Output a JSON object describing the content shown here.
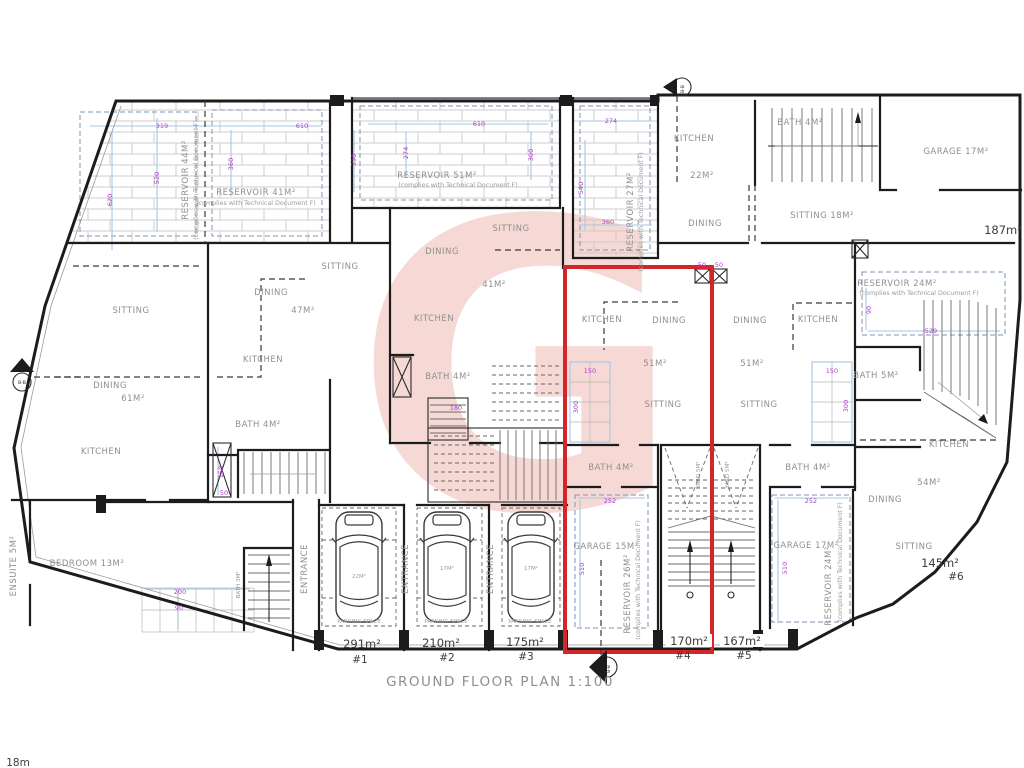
{
  "title": "GROUND FLOOR PLAN 1:100",
  "corner_note": "18m",
  "compliance_note": "(complies with Technical Document F)",
  "watermark_letter": "G",
  "reservoirs": {
    "r44": "RESERVOIR 44M²",
    "r41": "RESERVOIR 41M²",
    "r51": "RESERVOIR 51M²",
    "r27": "RESERVOIR 27M²",
    "r24_top": "RESERVOIR 24M²",
    "r26": "RESERVOIR 26M²",
    "r24_right": "RESERVOIR 24M²"
  },
  "rooms": {
    "u1_sitting": "SITTING",
    "u1_dining": "DINING",
    "u1_dining_area": "61M²",
    "u1_kitchen": "KITCHEN",
    "u1_bedroom": "BEDROOM 13M²",
    "u1_ensuite": "ENSUITE 5M²",
    "u1_bath": "BATH 3M²",
    "u2_sitting": "SITTING",
    "u2_dining": "DINING",
    "u2_dining_area": "47M²",
    "u2_kitchen": "KITCHEN",
    "u2_bath": "BATH 4M²",
    "u3_sitting": "SITTING",
    "u3_dining": "DINING",
    "u3_dining_area": "41M²",
    "u3_kitchen": "KITCHEN",
    "u3_bath": "BATH 4M²",
    "u4_kitchen": "KITCHEN",
    "u4_dining": "DINING",
    "u4_area": "51M²",
    "u4_sitting": "SITTING",
    "u4_bath": "BATH 4M²",
    "u4_garage": "GARAGE 15M²",
    "u4_yard": "YARD 5M²",
    "u5_dining": "DINING",
    "u5_kitchen": "KITCHEN",
    "u5_area": "51M²",
    "u5_sitting": "SITTING",
    "u5_bath": "BATH 4M²",
    "u5_bath5": "BATH 5M²",
    "u5_garage": "GARAGE 17M²",
    "u5_yard": "YARD 5M²",
    "u6_kitchen": "KITCHEN",
    "u6_area": "54M²",
    "u6_dining": "DINING",
    "u6_sitting": "SITTING",
    "tr_kitchen": "KITCHEN",
    "tr_area": "22M²",
    "tr_dining": "DINING",
    "tr_bath": "BATH 4M²",
    "tr_sitting": "SITTING 18M²",
    "tr_garage": "GARAGE 17M²"
  },
  "parking": {
    "entrance": "ENTRANCE",
    "space": "PARKING SPACE",
    "car1": "22M²",
    "car2": "17M²",
    "car3": "17M²"
  },
  "footer": {
    "a1": "291m²",
    "n1": "#1",
    "a2": "210m²",
    "n2": "#2",
    "a3": "175m²",
    "n3": "#3",
    "a4": "170m²",
    "n4": "#4",
    "a5": "167m²",
    "n5": "#5",
    "a6": "145m²",
    "n6": "#6",
    "tr": "187m²"
  },
  "dims": {
    "d319": "319",
    "d610a": "610",
    "d520": "520",
    "d620": "620",
    "d360a": "360",
    "d390": "390",
    "d610b": "610",
    "d274a": "274",
    "d300a": "300",
    "d274b": "274",
    "d540": "540",
    "d360b": "360",
    "d529": "529",
    "d90a": "90",
    "d150a": "150",
    "d300b": "300",
    "d150b": "150",
    "d300c": "300",
    "d252a": "252",
    "d510a": "510",
    "d252b": "252",
    "d510b": "510",
    "d200": "200",
    "d90b": "90",
    "d150c": "150",
    "d50a": "50",
    "d180": "180",
    "d50b": "50",
    "d50c": "50"
  },
  "markers": {
    "section": "B-B",
    "number": "1"
  }
}
